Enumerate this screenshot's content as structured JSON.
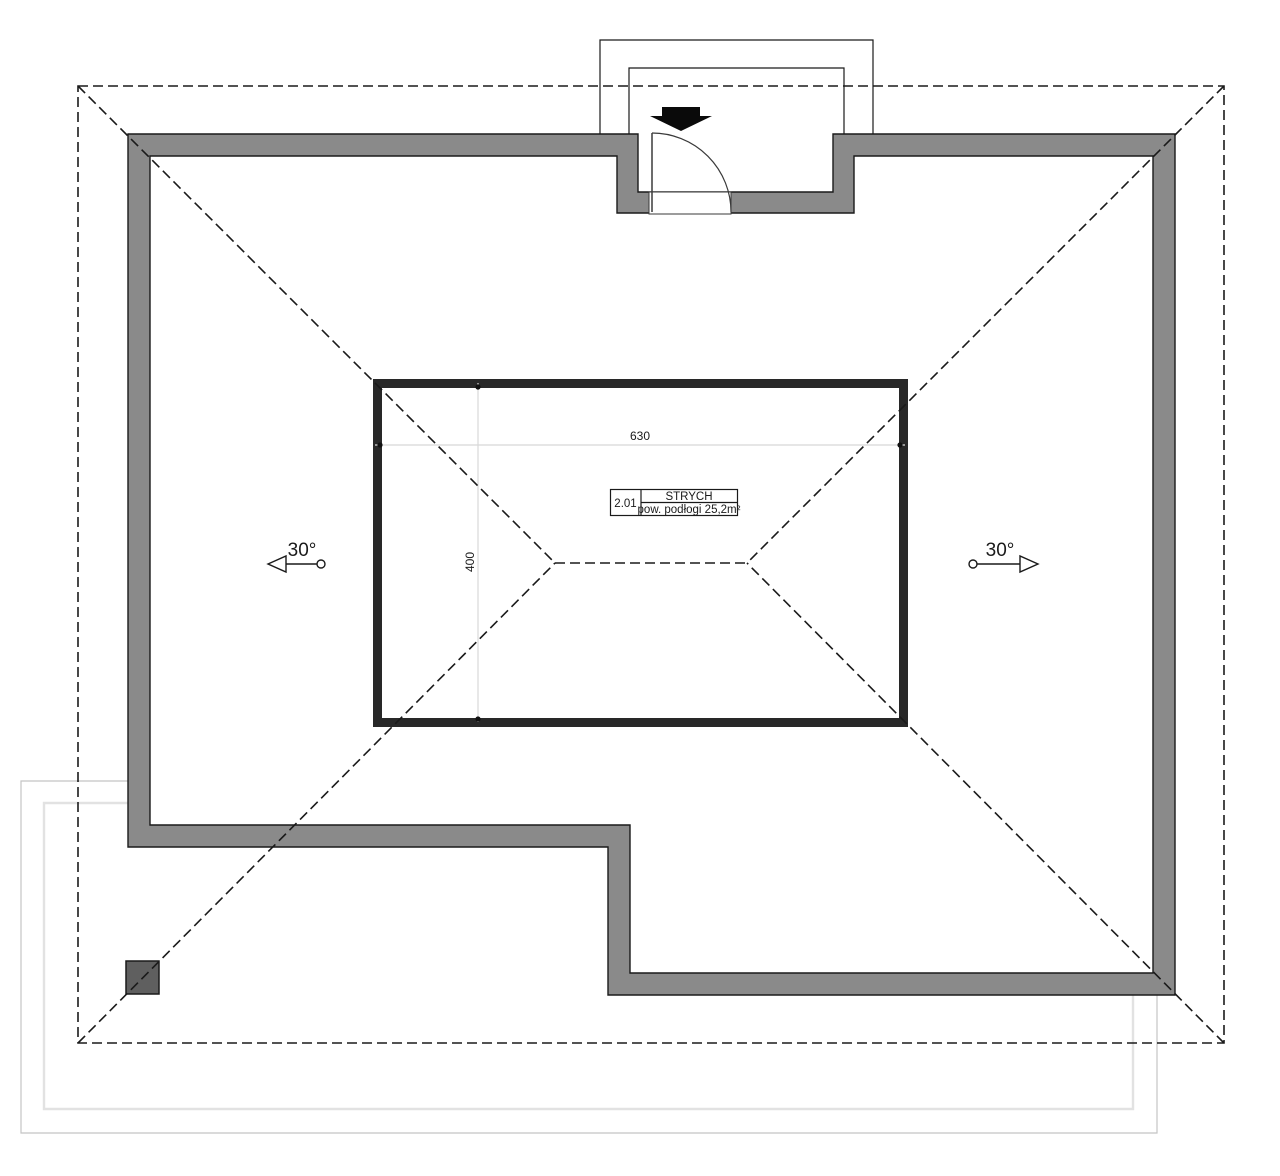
{
  "drawing": {
    "title": "roof-attic-plan",
    "room": {
      "number": "2.01",
      "name": "STRYCH",
      "area": "pow. podłogi 25,2m²"
    },
    "dimensions": {
      "width_cm": "630",
      "depth_cm": "400"
    },
    "roof": {
      "left_slope": "30°",
      "right_slope": "30°"
    },
    "colors": {
      "wall": "#8a8a8a",
      "chimney": "#5f5f5f",
      "knee_wall": "#282828",
      "dash_line": "#1a1a1a",
      "dim_line": "#d8d8d8",
      "terrace_outer": "#c4c4c4",
      "terrace_inner": "#e2e2e2"
    }
  }
}
